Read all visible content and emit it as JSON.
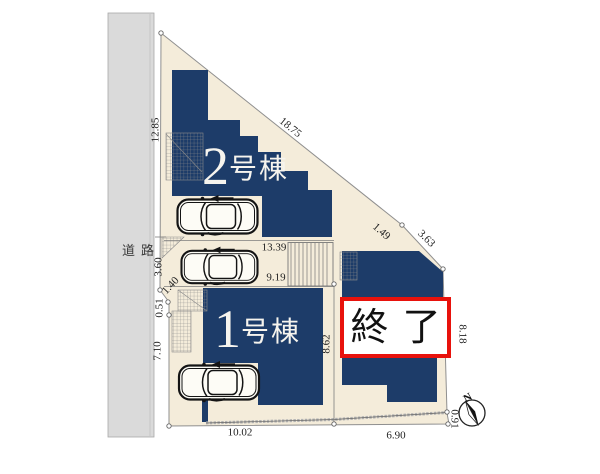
{
  "plan": {
    "road_label": "道路",
    "buildings": {
      "b2_number": "2",
      "b2_suffix": "号棟",
      "b1_number": "1",
      "b1_suffix": "号棟",
      "b3_status": "終了"
    },
    "compass_north": "N",
    "dimensions": {
      "left_12_85": "12.85",
      "left_3_60": "3.60",
      "left_1_40": "1.40",
      "left_0_51": "0.51",
      "left_7_10": "7.10",
      "top_18_75": "18.75",
      "top_1_49": "1.49",
      "top_3_63": "3.63",
      "mid_13_39": "13.39",
      "mid_9_19": "9.19",
      "mid_8_62": "8.62",
      "right_8_18": "8.18",
      "bottom_10_02": "10.02",
      "bottom_6_90": "6.90",
      "corner_0_91": "0.91"
    },
    "colors": {
      "building": "#1d3c69",
      "plot_fill": "#f4ecda",
      "road_fill": "#dadada",
      "status_red": "#e8120c"
    }
  }
}
